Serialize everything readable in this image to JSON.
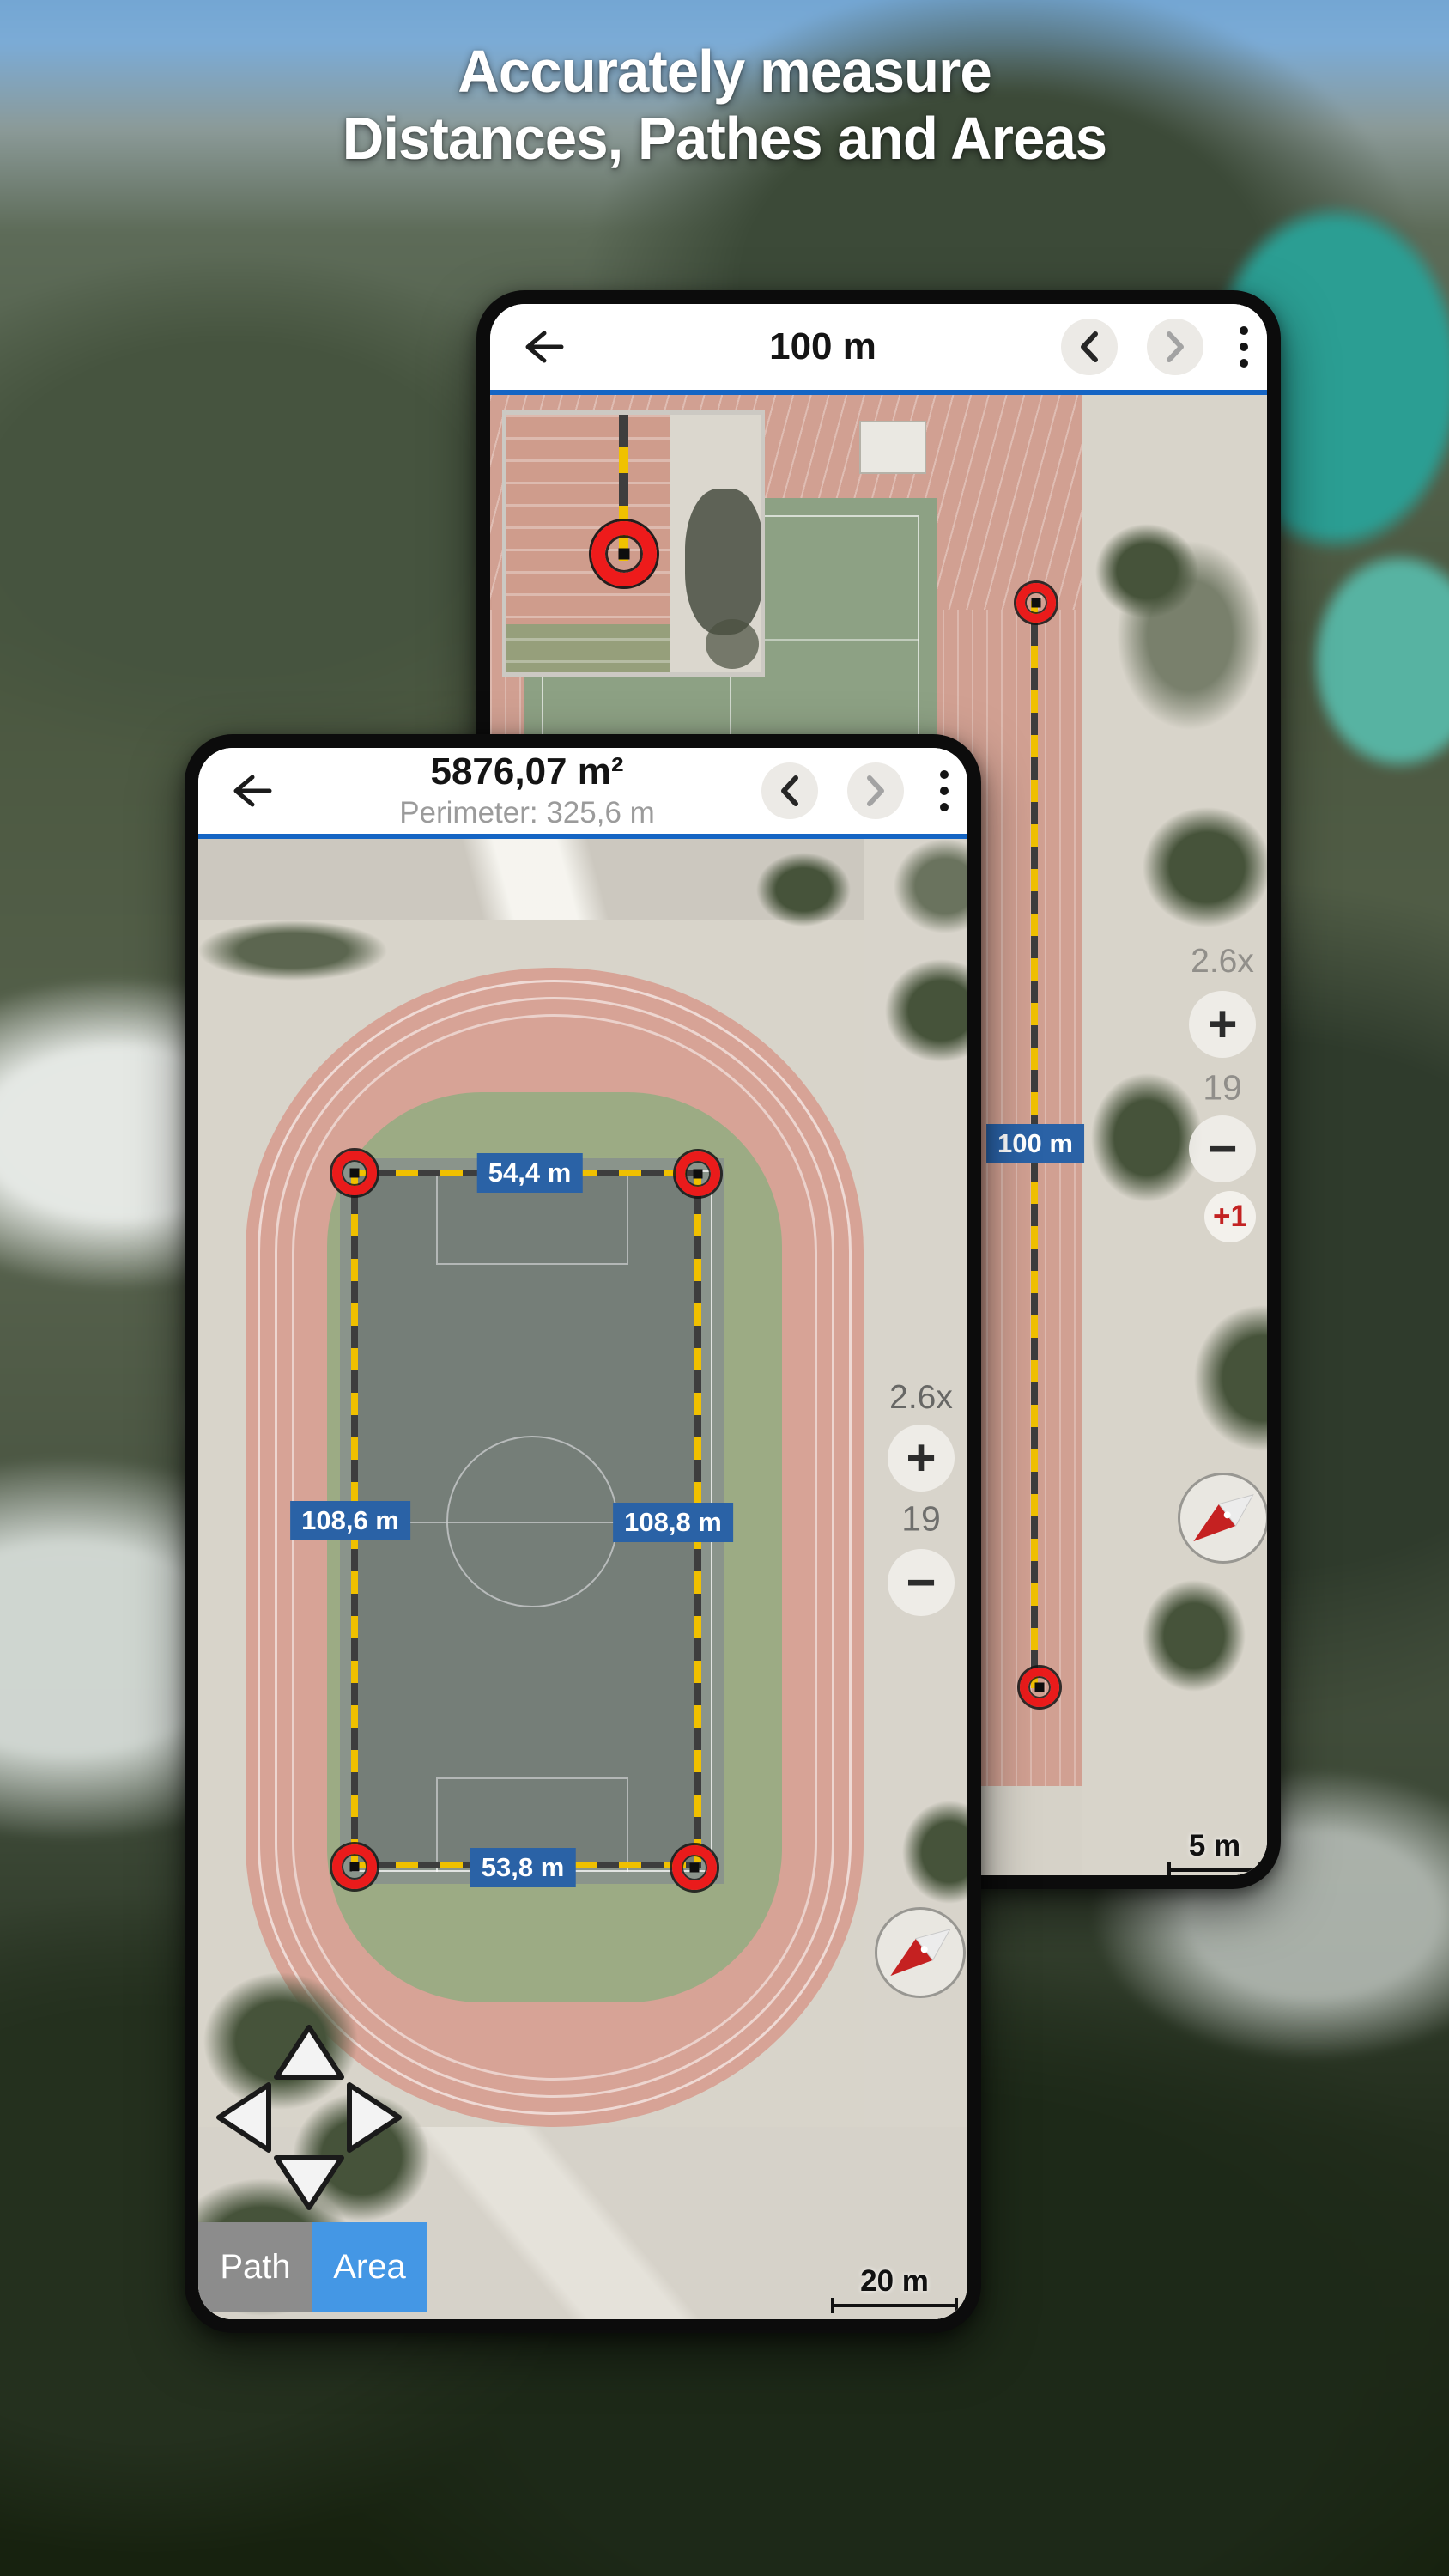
{
  "hero": {
    "title_line1": "Accurately measure",
    "title_line2": "Distances, Pathes and Areas"
  },
  "back_phone": {
    "header": {
      "title": "100 m"
    },
    "map": {
      "path_label": "100 m",
      "zoom_factor": "2.6x",
      "zoom_level": "19",
      "zoom_in": "+",
      "zoom_out": "−",
      "add_point": "+1",
      "scale_label": "5 m"
    }
  },
  "front_phone": {
    "header": {
      "title": "5876,07 m²",
      "subtitle": "Perimeter: 325,6 m"
    },
    "map": {
      "side_top": "54,4 m",
      "side_left": "108,6 m",
      "side_right": "108,8 m",
      "side_bottom": "53,8 m",
      "zoom_factor": "2.6x",
      "zoom_level": "19",
      "zoom_in": "+",
      "zoom_out": "−",
      "scale_label": "20 m",
      "modes": [
        {
          "label": "Path"
        },
        {
          "label": "Area"
        }
      ]
    }
  },
  "icons": {
    "back": "arrow-left",
    "prev": "chevron-left",
    "next": "chevron-right",
    "menu": "kebab-vertical",
    "compass": "compass-needle",
    "dpad": "pan-arrows"
  },
  "colors": {
    "accent_blue": "#1565c4",
    "label_blue": "#2a62a6",
    "marker_red": "#ea1b1b",
    "dash_yellow": "#f0c000",
    "area_button_blue": "#4497e5",
    "path_button_gray": "#8c8c8c"
  }
}
